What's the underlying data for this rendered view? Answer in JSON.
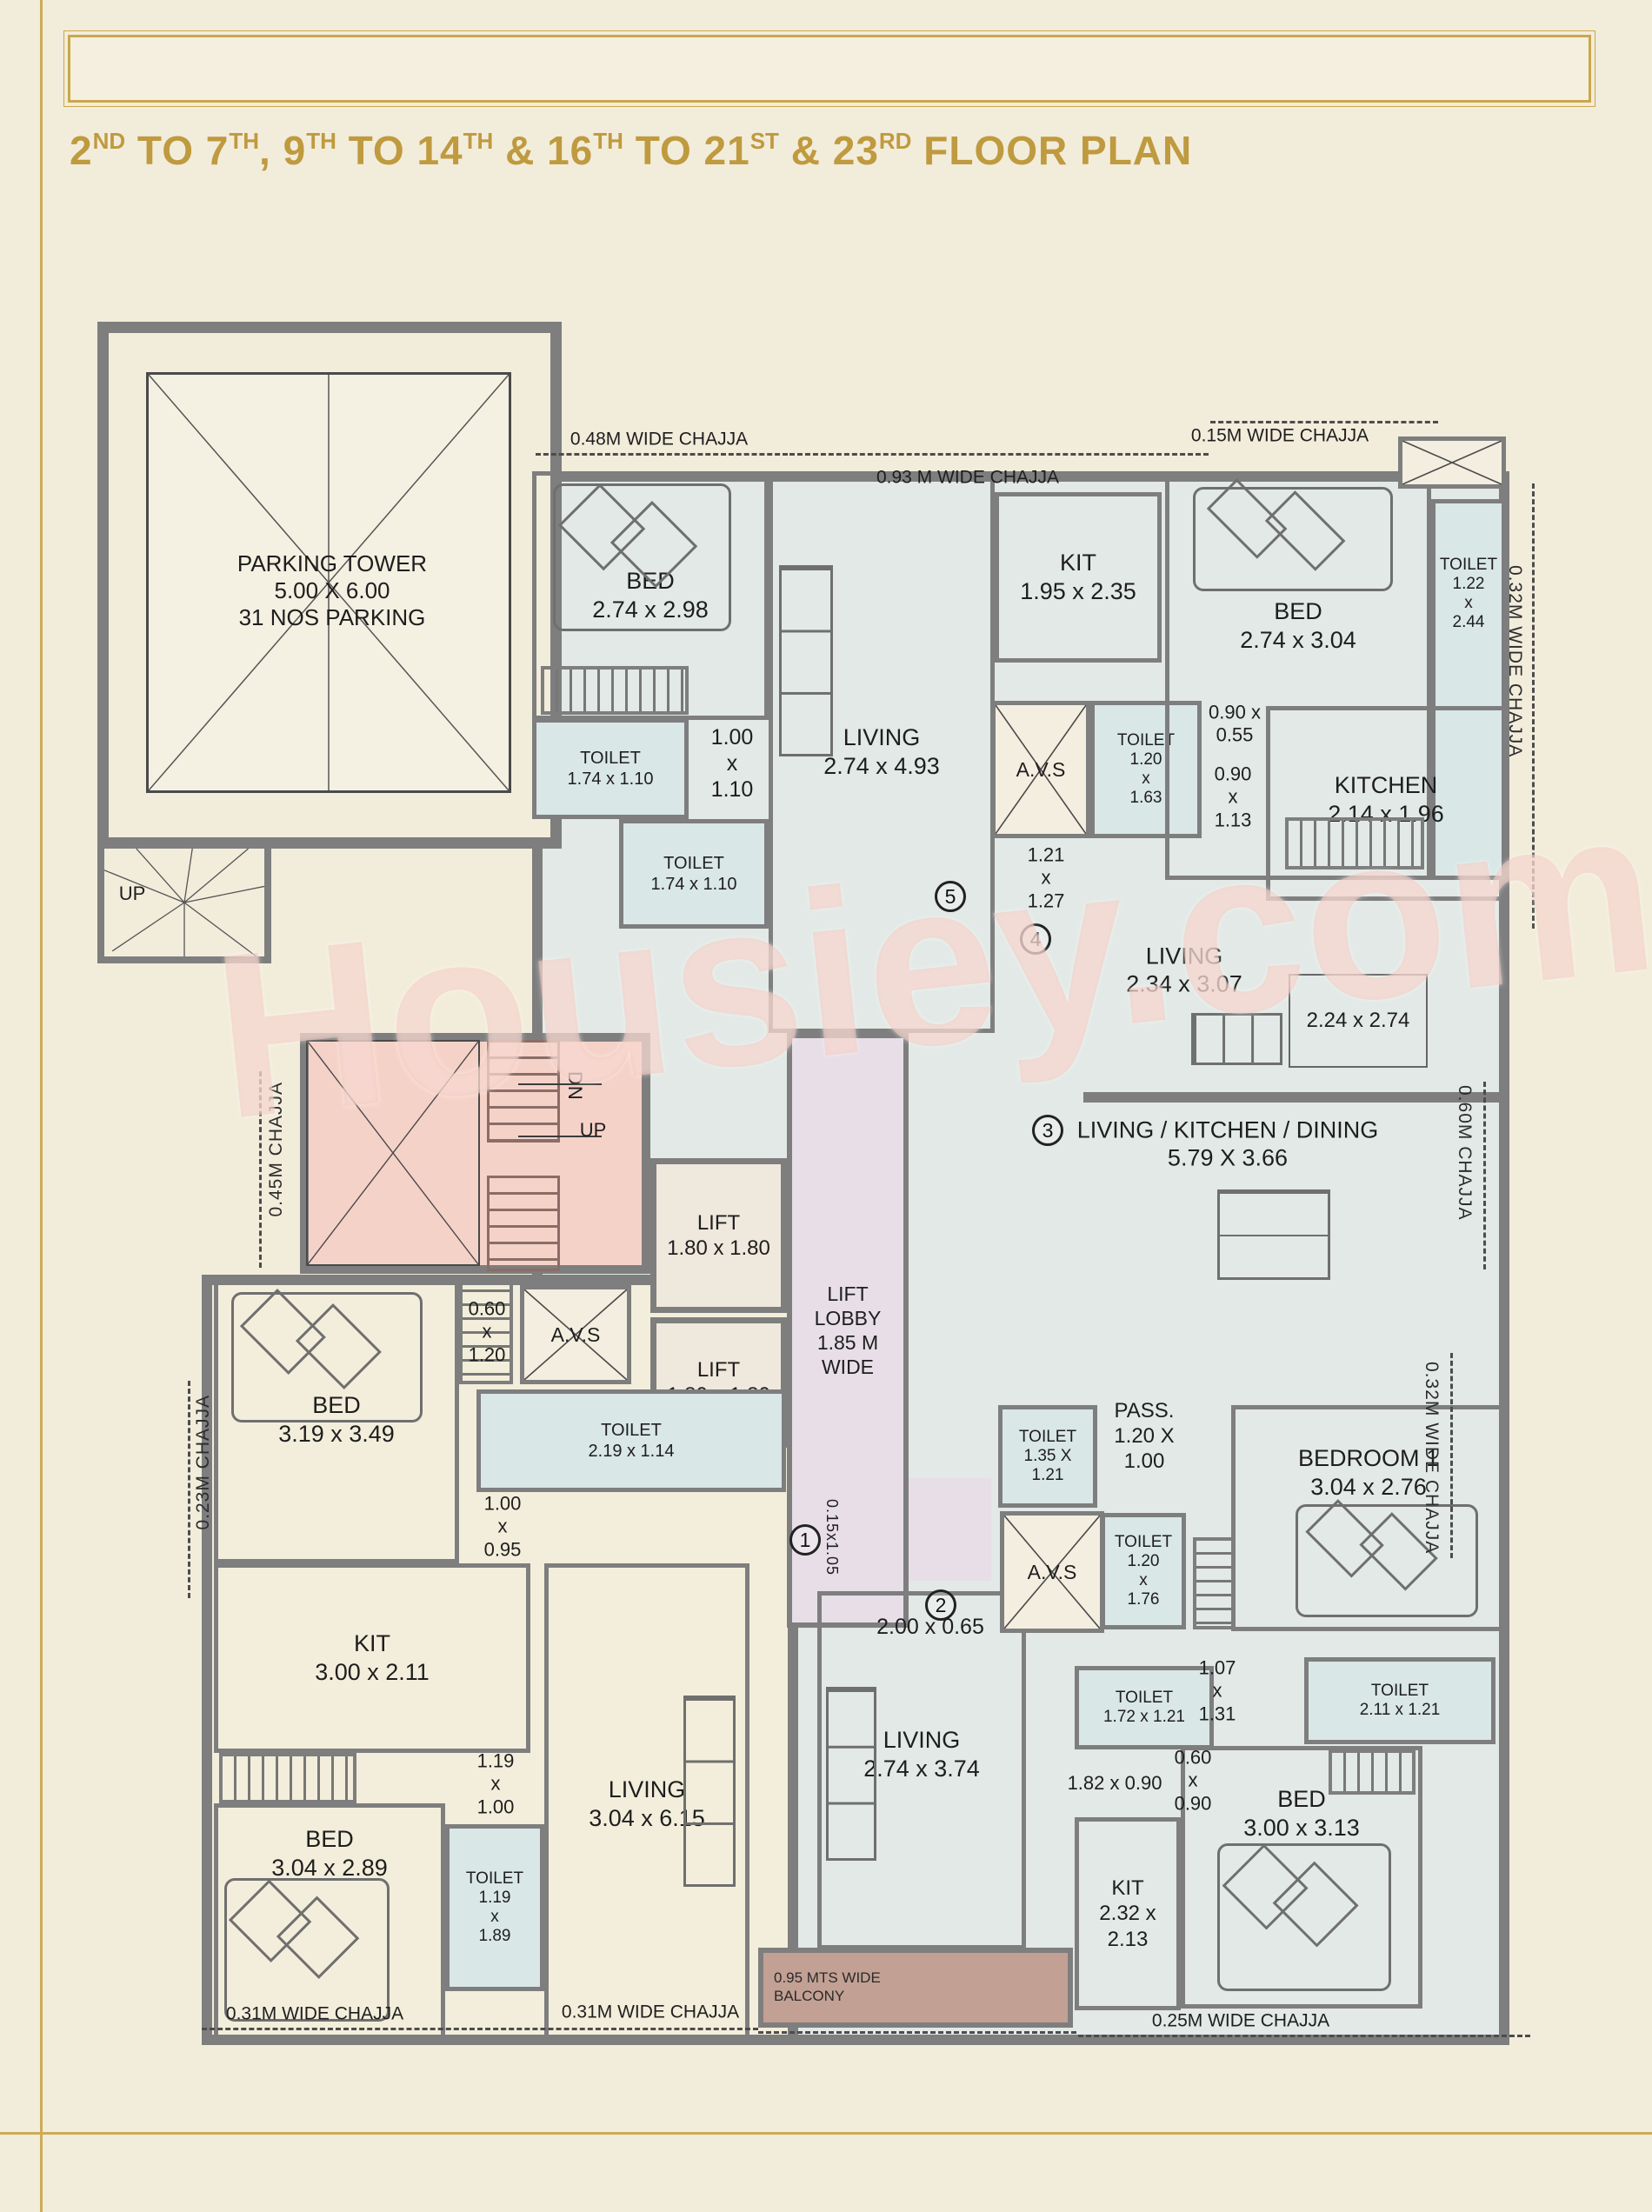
{
  "page": {
    "title_segments": [
      {
        "t": "2",
        "sup": "ND"
      },
      {
        "t": " TO 7",
        "sup": "TH"
      },
      {
        "t": ", 9",
        "sup": "TH"
      },
      {
        "t": " TO 14",
        "sup": "TH"
      },
      {
        "t": " & 16",
        "sup": "TH"
      },
      {
        "t": " TO 21",
        "sup": "ST"
      },
      {
        "t": " & 23",
        "sup": "RD"
      },
      {
        "t": " FLOOR PLAN",
        "sup": ""
      }
    ],
    "watermark": "Housiey.com"
  },
  "colors": {
    "accent_gold": "#bf9a3e",
    "frame_gold": "#cdab55",
    "wall_gray": "#7e7e7e",
    "room_blue": "#e2e9e6",
    "toilet_blue": "#d9e7e6",
    "room_cream": "#f3eedb",
    "stair_pink": "#f5d2c8",
    "lobby_lavender": "#e7dee7",
    "balcony_brown": "#c3a094",
    "paper": "#f2ecdb",
    "watermark_pink": "#f3c6bc"
  },
  "plan": {
    "avs": "A.V.S",
    "parking": {
      "label": "PARKING TOWER\n5.00 X 6.00\n31 NOS PARKING",
      "stair_up": "UP"
    },
    "stair": {
      "dn": "DN",
      "up": "UP"
    },
    "rooms": {
      "bed_top_left": "BED\n2.74 x 2.98",
      "toilet_top_left_1": "TOILET\n1.74 x 1.10",
      "toilet_top_left_2": "TOILET\n1.74 x 1.10",
      "living_top_left": "LIVING\n2.74 x 4.93",
      "kit_top_left": "KIT\n1.95 x 2.35",
      "bed_top_right": "BED\n2.74 x 3.04",
      "toilet_top_right": "TOILET\n1.22\nx\n2.44",
      "toilet_avs_top": "TOILET\n1.20\nx\n1.63",
      "kitchen_top_right": "KITCHEN\n2.14 x 1.96",
      "living_right": "LIVING\n2.34 x 3.07",
      "rug_dims": "2.24 x 2.74",
      "living_kitchen_dining": "LIVING / KITCHEN / DINING\n5.79 X 3.66",
      "lift": "LIFT\n1.80 x 1.80",
      "lift_lobby": "LIFT LOBBY\n1.85 M WIDE",
      "toilet_core": "TOILET\n2.19 x 1.14",
      "bed_mid_left": "BED\n3.19 x 3.49",
      "kit_mid_left": "KIT\n3.00 x 2.11",
      "bed_bottom_left": "BED\n3.04 x 2.89",
      "toilet_bottom_left": "TOILET\n1.19\nx\n1.89",
      "living_bottom_left": "LIVING\n3.04 x 6.15",
      "living_bottom_mid": "LIVING\n2.74 x 3.74",
      "toilet_passage": "TOILET\n1.35 X\n1.21",
      "passage": "PASS.\n1.20 X\n1.00",
      "toilet_bedroom1": "TOILET\n1.20\nx\n1.76",
      "bedroom1": "BEDROOM 1\n3.04 x 2.76",
      "toilet_bottom_right_1": "TOILET\n1.72 x 1.21",
      "toilet_bottom_right_2": "TOILET\n2.11 x 1.21",
      "kit_bottom_right": "KIT\n2.32 x 2.13",
      "bed_bottom_right": "BED\n3.00 x 3.13"
    },
    "dims": {
      "pass_top_left": "1.00\nx\n1.10",
      "d_090_055": "0.90 x\n0.55",
      "d_090_113": "0.90\nx\n1.13",
      "d_121_127": "1.21\nx\n1.27",
      "d_060_120": "0.60\nx\n1.20",
      "d_100_095": "1.00\nx\n0.95",
      "d_119_100": "1.19\nx\n1.00",
      "d_200_065": "2.00 x 0.65",
      "v_015_105": "0.15x1.05",
      "d_107_131": "1.07\nx\n1.31",
      "d_182_090": "1.82 x 0.90",
      "d_060_090": "0.60\nx\n0.90"
    },
    "chajja": {
      "top_left": "0.48M WIDE CHAJJA",
      "top_mid": "0.93 M WIDE CHAJJA",
      "top_right": "0.15M WIDE CHAJJA",
      "right_top": "0.32M WIDE CHAJJA",
      "right_mid": "0.60M CHAJJA",
      "right_low": "0.32M WIDE CHAJJA",
      "left_up": "0.45M CHAJJA",
      "left_low": "0.23M CHAJJA",
      "bottom_left": "0.31M WIDE CHAJJA",
      "bottom_mid": "0.31M WIDE CHAJJA",
      "bottom_right": "0.25M WIDE CHAJJA",
      "balcony": "0.95 MTS WIDE\nBALCONY"
    },
    "circles": {
      "n1": "1",
      "n2": "2",
      "n3": "3",
      "n4": "4",
      "n5": "5"
    }
  }
}
